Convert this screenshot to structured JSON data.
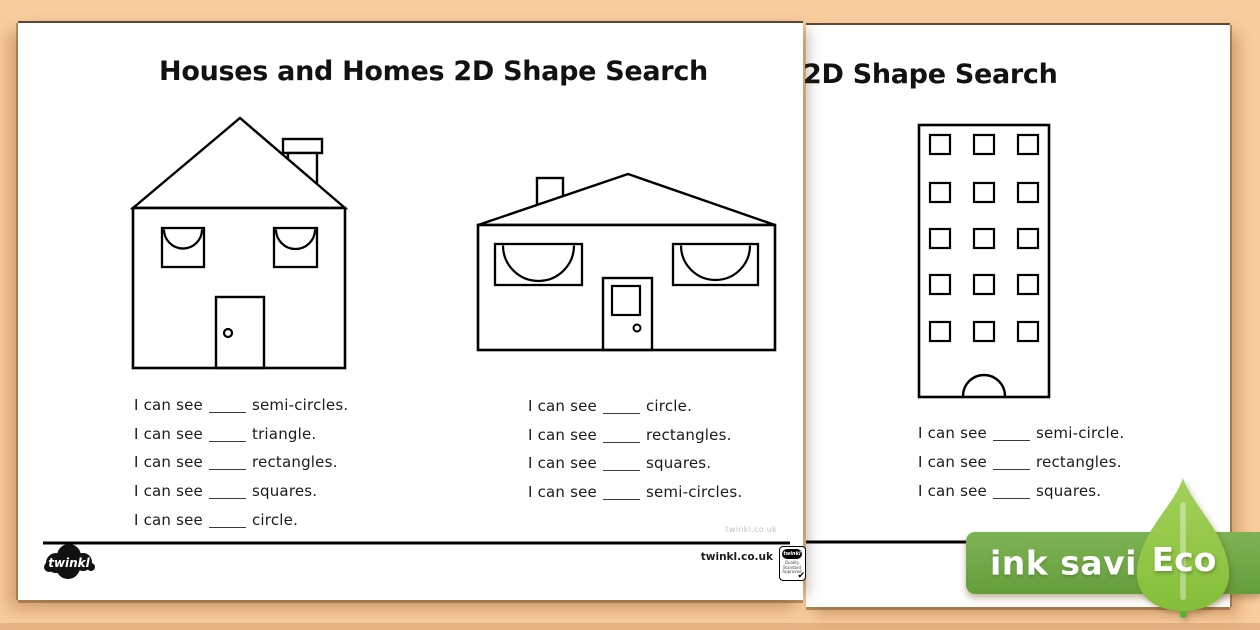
{
  "background_color": "#f9cd9e",
  "front_page": {
    "title": "Houses and Homes 2D Shape Search",
    "prefix": "I can see",
    "detached_house_questions": [
      "semi-circles.",
      "triangle.",
      "rectangles.",
      "squares.",
      "circle."
    ],
    "bungalow_questions": [
      "circle.",
      "rectangles.",
      "squares.",
      "semi-circles."
    ],
    "footer": {
      "watermark": "twinkl.co.uk",
      "website": "twinkl.co.uk",
      "logo_text": "twinkl",
      "badge_logo_text": "twinkl",
      "badge_caption": "Quality Standard Approved",
      "badge_check": "✔"
    }
  },
  "back_page": {
    "title": "2D Shape Search",
    "prefix": "I can see",
    "tower_block_questions": [
      "semi-circle.",
      "rectangles.",
      "squares."
    ]
  },
  "eco_banner": {
    "banner_label": "ink saving",
    "leaf_label": "Eco",
    "banner_green": "#6fa742",
    "leaf_green": "#8fc640"
  }
}
